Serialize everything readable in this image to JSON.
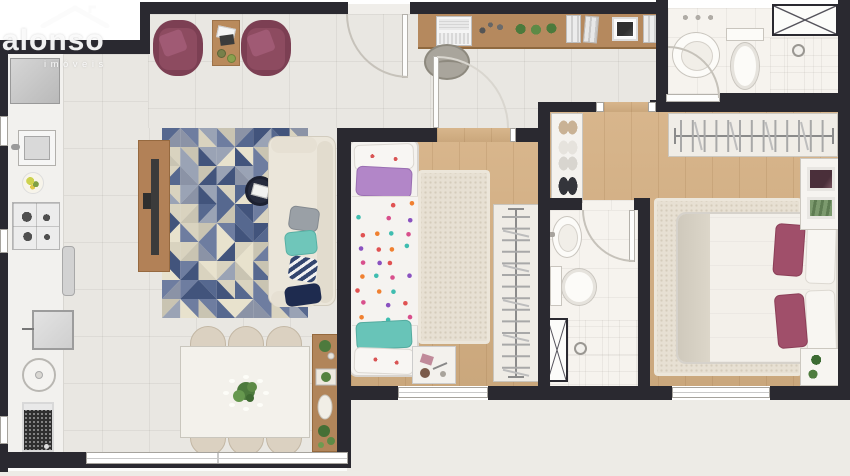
{
  "watermark": {
    "brand": "alonso",
    "tagline": "imóveis",
    "icon": "house-roof-icon"
  },
  "palette": {
    "wall": "#2a2930",
    "tile_floor": "#e9e7e2",
    "wood_floor": "#d5b083",
    "bath_floor": "#f6f3ee",
    "exterior_bottom": "#edebe6",
    "accent_maroon": "#8d4b60",
    "accent_lavender": "#b286c8",
    "accent_teal": "#68c4b8",
    "sofa_cream": "#ebe6da",
    "rug_triangles": [
      "#56688f",
      "#6e7da0",
      "#9aa3b5",
      "#e8e2cd",
      "#c9c4b2",
      "#42547c",
      "#8b93a6",
      "#d9d3bf"
    ],
    "duvet_dots": [
      "#e05252",
      "#f08030",
      "#3fbdb0",
      "#d84f8c",
      "#8a52c0"
    ]
  },
  "legend": {
    "rooms": [
      "kitchen",
      "laundry",
      "living-room",
      "dining-area",
      "home-office-nook",
      "bedroom-2",
      "suite-hall",
      "bathroom-social",
      "bathroom-suite",
      "master-bedroom",
      "closet"
    ],
    "furniture": [
      "refrigerator",
      "kitchen-sink",
      "gas-stove",
      "laundry-tank",
      "washing-machine",
      "armchair",
      "side-table",
      "tv-console",
      "tv",
      "triangle-area-rug",
      "pouf-tray",
      "sofa",
      "dining-table",
      "dining-chair",
      "sideboard",
      "desk",
      "laptop",
      "desk-chair",
      "single-bed",
      "double-bed",
      "wardrobe-hangers",
      "shoe-rack",
      "washbasin",
      "toilet",
      "shower-head",
      "nightstand",
      "window",
      "door",
      "duct-shaft"
    ]
  }
}
